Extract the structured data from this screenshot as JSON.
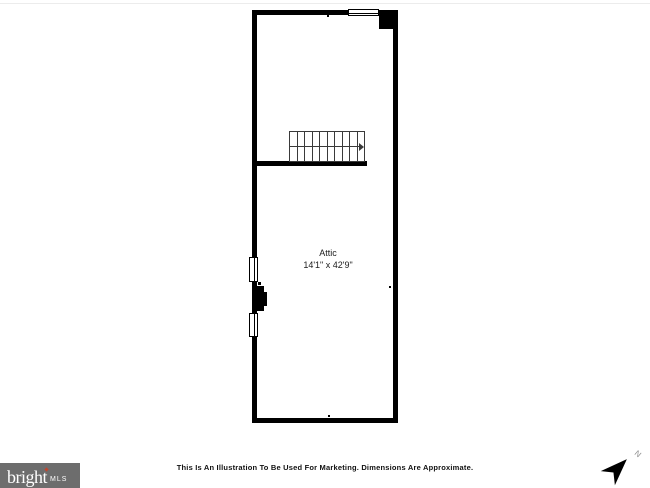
{
  "canvas": {
    "background_color": "#ffffff",
    "wall_color": "#000000"
  },
  "floor_plan": {
    "room": {
      "label": "Attic",
      "dimensions": "14'1\" x 42'9\""
    },
    "stairs": {
      "step_count": 10,
      "direction": "right"
    }
  },
  "footer": {
    "disclaimer": "This Is An Illustration To Be Used For Marketing. Dimensions Are Approximate.",
    "logo": {
      "brand": "bright",
      "suffix": "MLS",
      "background_color": "#6d6d6d",
      "spark_color": "#c0452e",
      "text_color": "#ffffff"
    },
    "compass": {
      "north_label": "N"
    }
  }
}
